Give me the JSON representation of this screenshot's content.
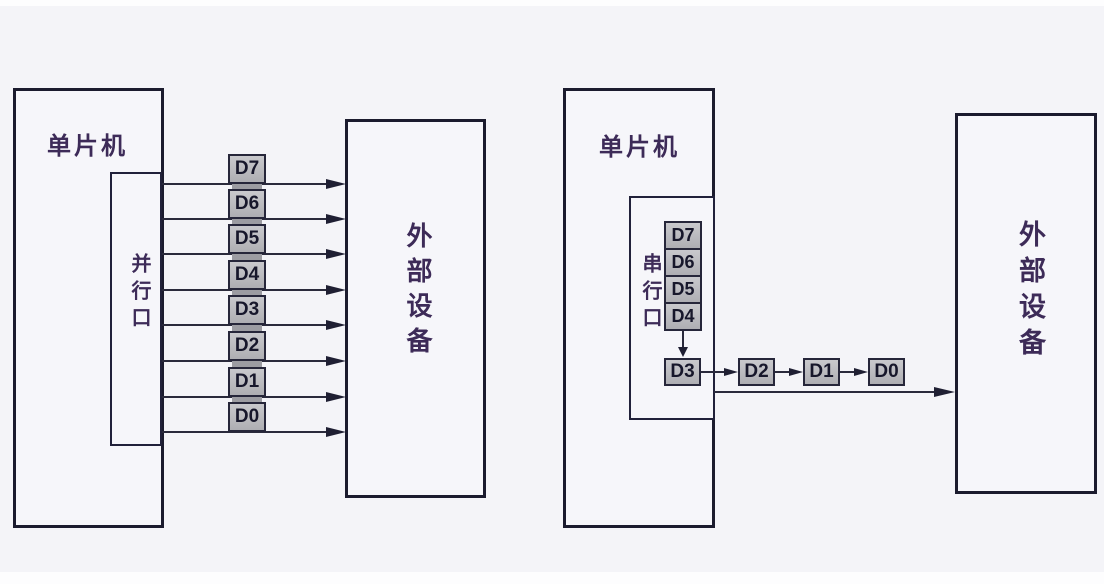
{
  "figure": {
    "parallel": {
      "mcu_label": "单片机",
      "port_label": "并行口",
      "device_label": "外部设备",
      "bus_bits": [
        "D7",
        "D6",
        "D5",
        "D4",
        "D3",
        "D2",
        "D1",
        "D0"
      ]
    },
    "serial": {
      "mcu_label": "单片机",
      "port_label": "串行口",
      "device_label": "外部设备",
      "shift_register_bits": [
        "D7",
        "D6",
        "D5",
        "D4"
      ],
      "current_bit": "D3",
      "transmitted_bits": [
        "D2",
        "D1",
        "D0"
      ]
    }
  },
  "colors": {
    "background": "#f4f4f8",
    "box_border": "#1b1b2e",
    "wire": "#2a2a3c",
    "chinese_text": "#3d2b58",
    "bit_box_fill": "#b4b4b9",
    "bit_box_border": "#26263a",
    "bit_text": "#17172b"
  }
}
